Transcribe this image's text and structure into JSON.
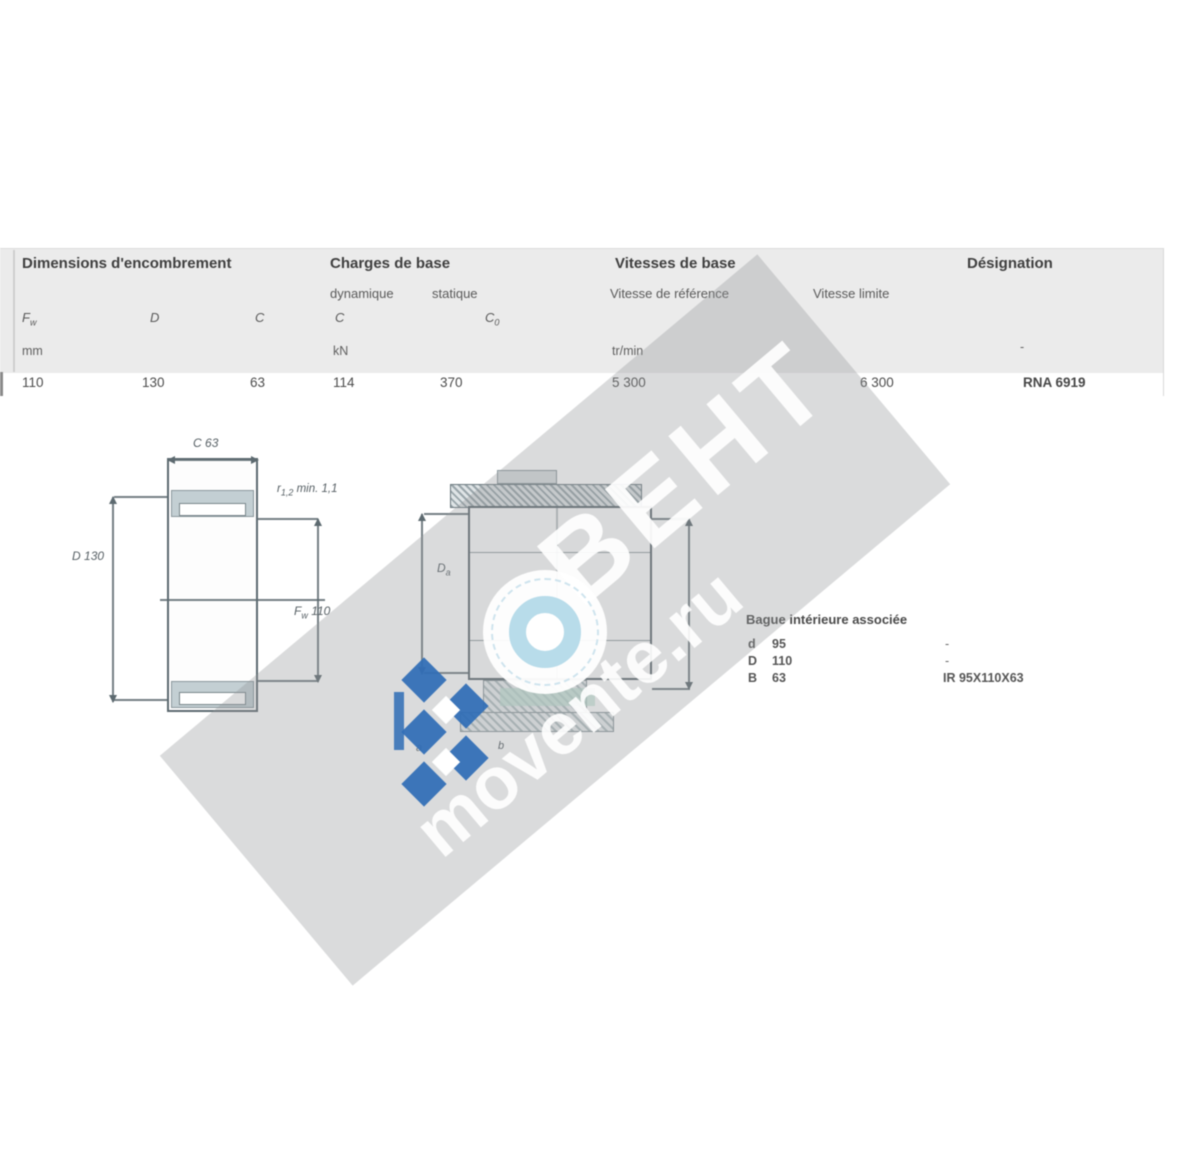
{
  "table": {
    "group_headers": [
      {
        "label": "Dimensions d'encombrement"
      },
      {
        "label": "Charges de base"
      },
      {
        "label": "Vitesses de base"
      },
      {
        "label": "Désignation"
      }
    ],
    "sub_headers": {
      "dyn": "dynamique",
      "stat": "statique",
      "vref": "Vitesse de référence",
      "vlim": "Vitesse limite"
    },
    "symbols": {
      "fw_base": "F",
      "fw_sub": "w",
      "d": "D",
      "c": "C",
      "c_dyn": "C",
      "c0_base": "C",
      "c0_sub": "0"
    },
    "units": {
      "dims": "mm",
      "loads": "kN",
      "speeds": "tr/min",
      "designation": "-"
    },
    "row": {
      "fw": "110",
      "d": "130",
      "c": "63",
      "c_dyn": "114",
      "c0": "370",
      "v_ref": "5 300",
      "v_lim": "6 300",
      "designation": "RNA 6919"
    }
  },
  "left_drawing": {
    "dim_top_sym": "C",
    "dim_top_val": "63",
    "dim_left_sym": "D",
    "dim_left_val": "130",
    "dim_right_sym": "F",
    "dim_right_sub": "w",
    "dim_right_val": "110",
    "note_sym": "r",
    "note_sub": "1,2",
    "note_rest": "min. 1,1"
  },
  "right_drawing": {
    "dim_left_sym": "D",
    "dim_left_sub": "a",
    "label_a": "a",
    "label_b": "b"
  },
  "inner_ring": {
    "title": "Bague intérieure associée",
    "rows": [
      {
        "label": "d",
        "value": "95",
        "right": "-"
      },
      {
        "label": "D",
        "value": "110",
        "right": "-"
      },
      {
        "label": "B",
        "value": "63",
        "right": "IR 95X110X63"
      }
    ]
  },
  "watermark": {
    "big": "BEHT",
    "site": "movente.ru"
  },
  "colors": {
    "accent_blue": "#2f6db6",
    "ring_blue": "#b8dcea",
    "band_gray": "#929597",
    "line": "#5d6a70",
    "ring_fill": "#c3cfd3"
  }
}
